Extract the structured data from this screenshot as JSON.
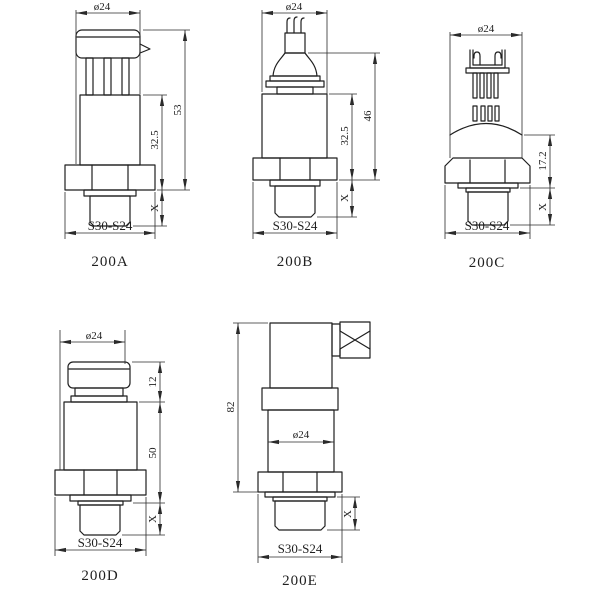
{
  "page": {
    "background": "#ffffff",
    "line_color": "#1f1f1f"
  },
  "figures": {
    "a": {
      "caption": "200A",
      "dims": {
        "width": "ø24",
        "overall": "53",
        "body": "32.5",
        "thread": "X",
        "wrench": "S30-S24"
      }
    },
    "b": {
      "caption": "200B",
      "dims": {
        "width": "ø24",
        "overall": "46",
        "body": "32.5",
        "thread": "X",
        "wrench": "S30-S24"
      }
    },
    "c": {
      "caption": "200C",
      "dims": {
        "width": "ø24",
        "height": "17.2",
        "thread": "X",
        "wrench": "S30-S24"
      }
    },
    "d": {
      "caption": "200D",
      "dims": {
        "width": "ø24",
        "connector": "12",
        "body": "50",
        "thread": "X",
        "wrench": "S30-S24"
      }
    },
    "e": {
      "caption": "200E",
      "dims": {
        "overall": "82",
        "width": "ø24",
        "thread": "X",
        "wrench": "S30-S24"
      }
    }
  }
}
